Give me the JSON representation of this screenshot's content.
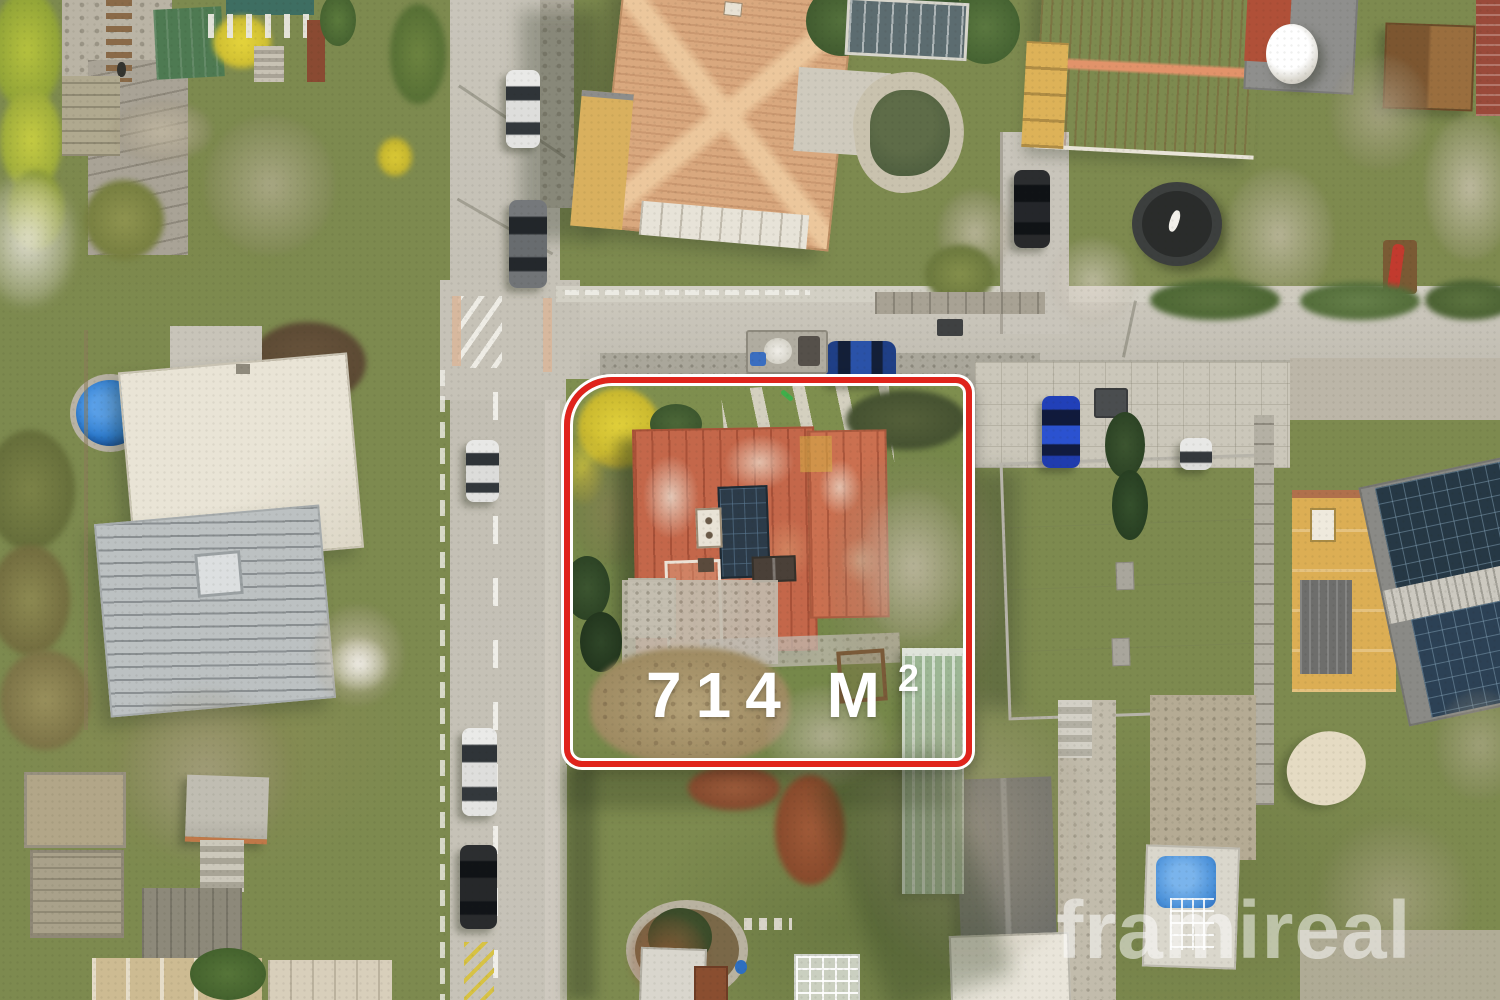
{
  "overlay": {
    "area_main": "714 M",
    "area_sup": "2",
    "area_label_full": "714 M²",
    "watermark": "framireal"
  },
  "palette": {
    "boundary_red": "#e0241c",
    "boundary_outline_white": "#ffffff",
    "area_text_white": "#ffffff",
    "watermark_white": "#ffffff",
    "lawn_green": "#7d8a4f",
    "road_gray": "#c6c2b8",
    "cobble_band_gray": "#aaa79b",
    "roof_rust_orange": "#c05a3e",
    "roof_terracotta_light": "#d9a87e",
    "roof_terracotta_bright": "#c05c38",
    "solar_panel_dark_blue": "#2c3b49",
    "pool_cover_blue": "#2e7dd0",
    "garden_pool_blue": "#4a90d8",
    "forsythia_yellow": "#d9c636",
    "shed_green": "#9cb694",
    "soil_tan": "#ab9a76",
    "white_flat_roof": "#eae6dc",
    "gray_metal_roof": "#bcc1c2"
  }
}
